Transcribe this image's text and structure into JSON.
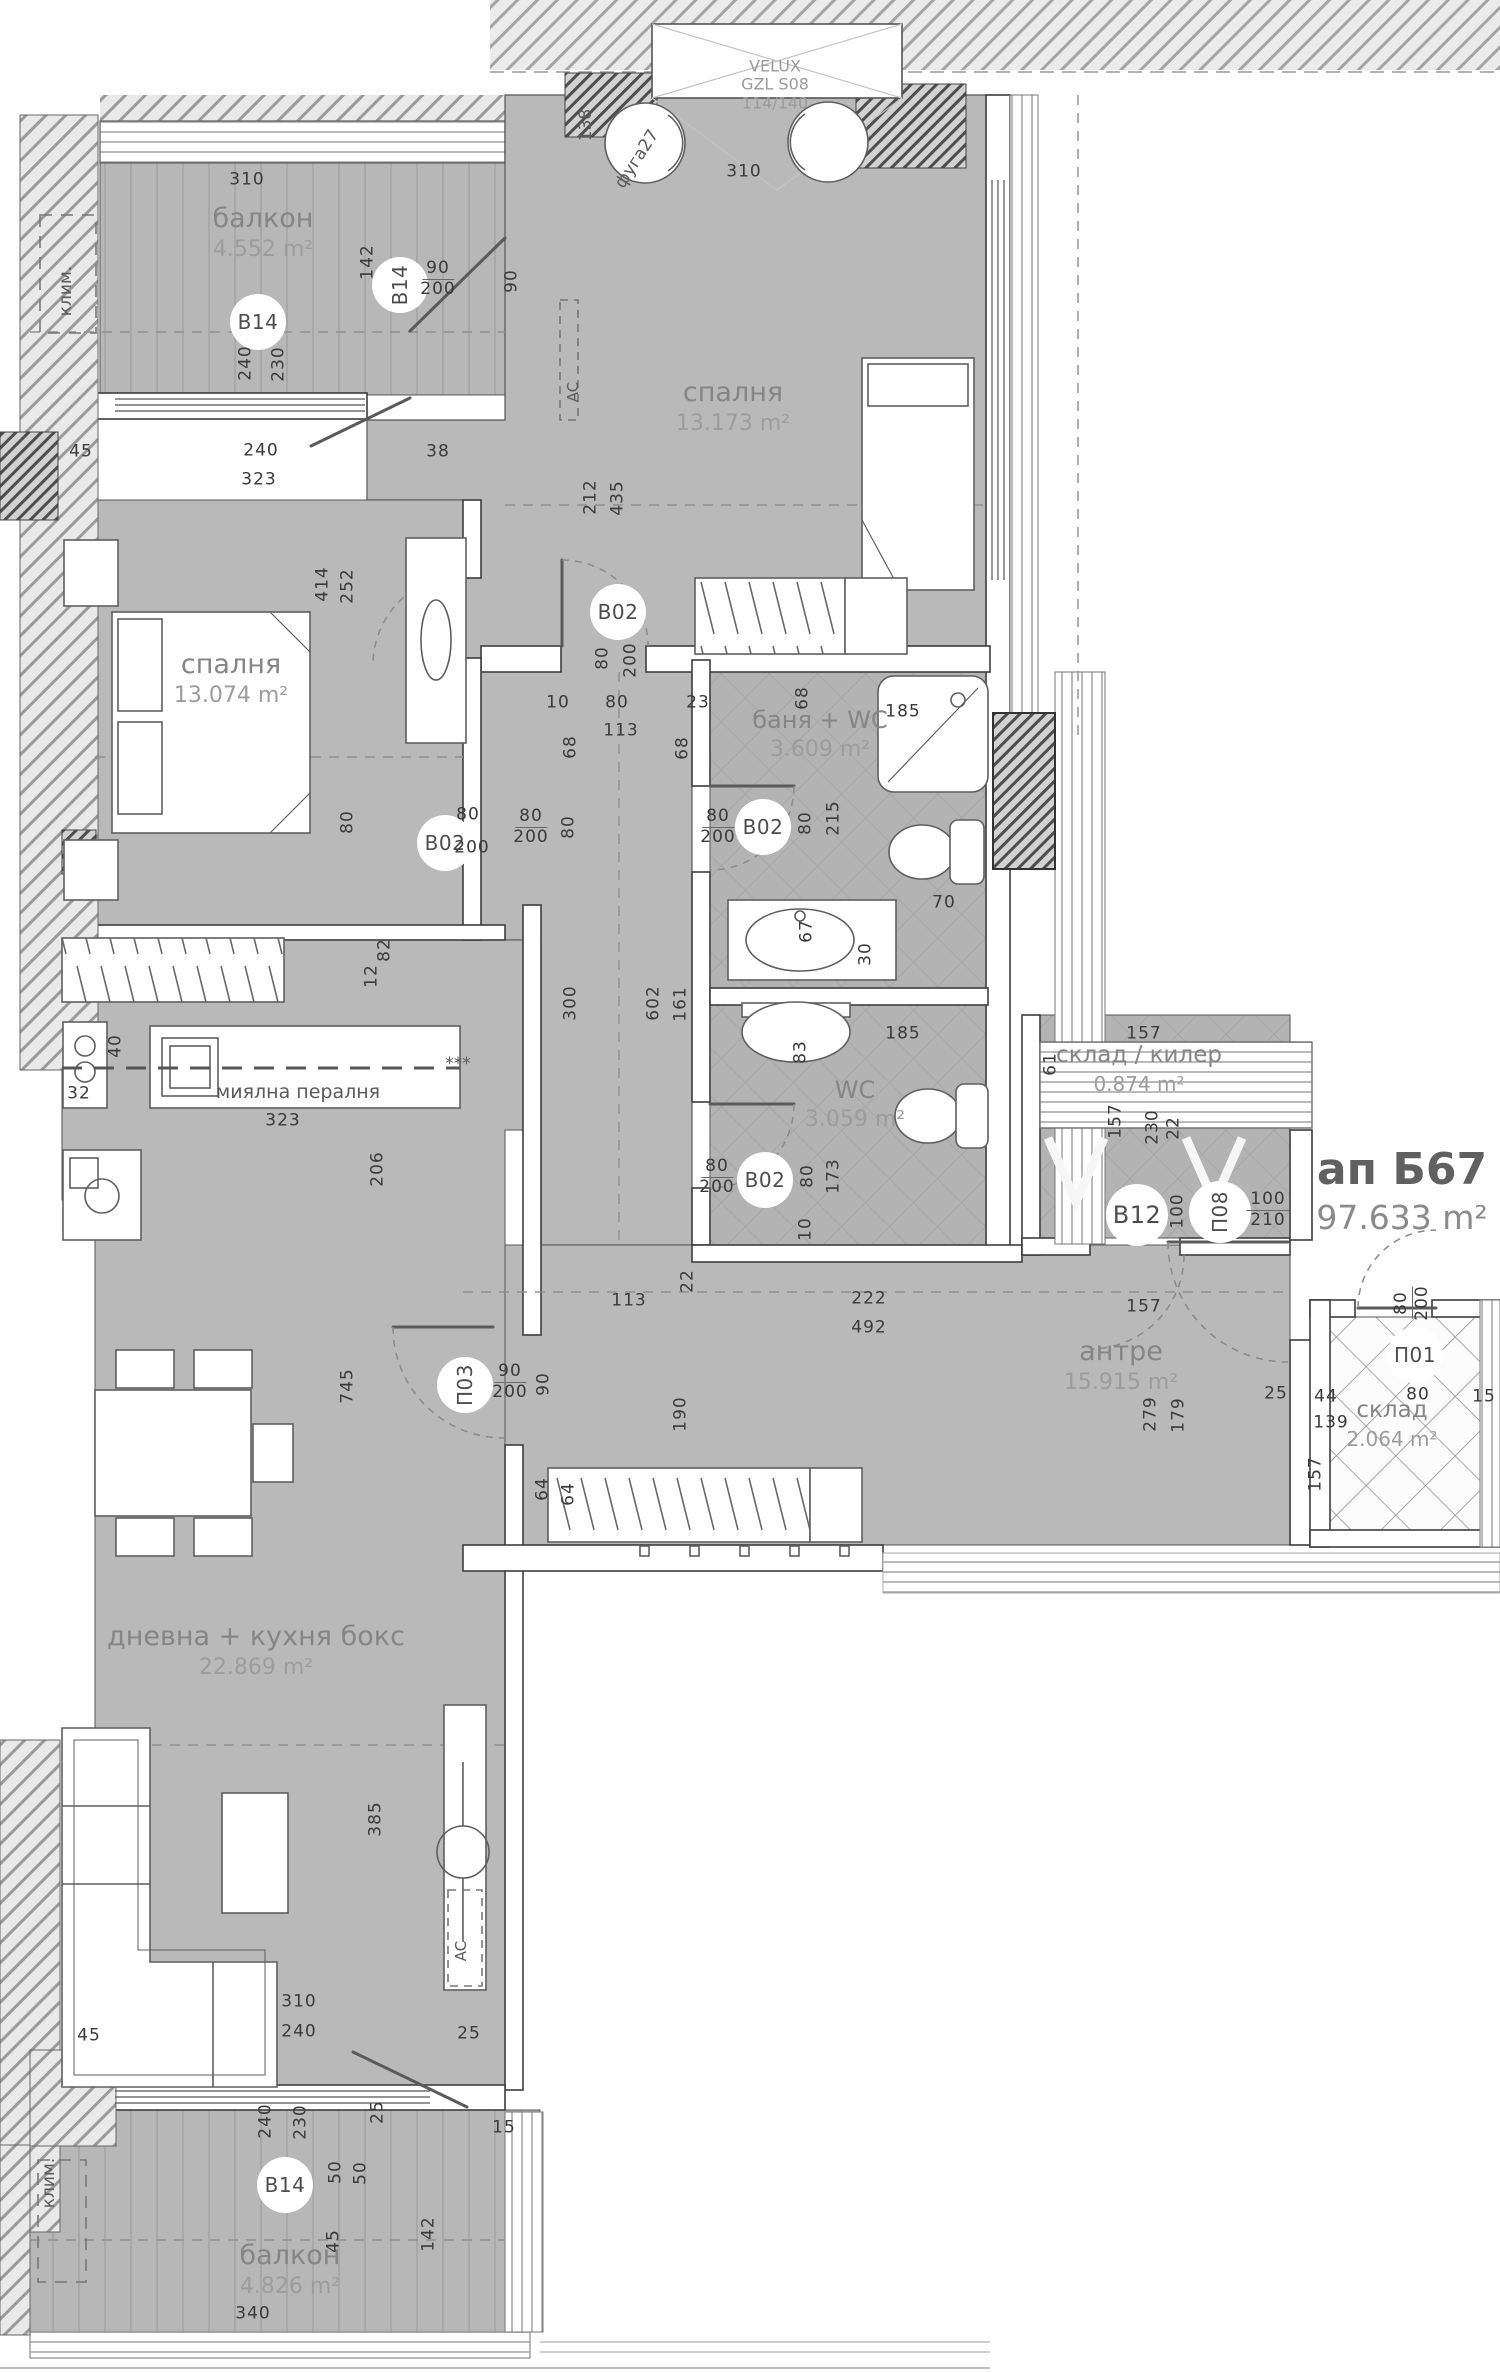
{
  "apartment": {
    "id": "ап Б67",
    "area": "97.633 m²"
  },
  "rooms": [
    {
      "key": "balcony_top",
      "name": "балкон",
      "area": "4.552 m²"
    },
    {
      "key": "bedroom_top",
      "name": "спалня",
      "area": "13.173 m²"
    },
    {
      "key": "bedroom_left",
      "name": "спалня",
      "area": "13.074 m²"
    },
    {
      "key": "bath_wc",
      "name": "баня + WC",
      "area": "3.609 m²"
    },
    {
      "key": "wc",
      "name": "WC",
      "area": "3.059 m²"
    },
    {
      "key": "storage_closet",
      "name": "склад / килер",
      "area": "0.874 m²"
    },
    {
      "key": "hallway",
      "name": "антре",
      "area": "15.915 m²"
    },
    {
      "key": "storage",
      "name": "склад",
      "area": "2.064 m²"
    },
    {
      "key": "living",
      "name": "дневна + кухня бокс",
      "area": "22.869 m²"
    },
    {
      "key": "balcony_bottom",
      "name": "балкон",
      "area": "4.826 m²"
    }
  ],
  "velux": {
    "brand": "VELUX",
    "model": "GZL S08",
    "size": "114/140"
  },
  "markers": {
    "b14": "B14",
    "b02": "B02",
    "b12": "B12",
    "p03": "П03",
    "p08": "П08",
    "p01": "П01"
  },
  "annotations": {
    "klim": "клим.",
    "ac": "AC",
    "appliances": "миялна пералня",
    "stars": "***",
    "fuga": "фуга27",
    "num138": "138"
  },
  "colors": {
    "floor": "#b9b9b9",
    "wall_line": "#3e3e3e",
    "dim_text": "#3a3a3a",
    "room_text": "#858585"
  },
  "dims": [
    "310",
    "310",
    "142",
    "90",
    "200",
    "90",
    "240",
    "230",
    "45",
    "240",
    "323",
    "38",
    "212",
    "435",
    "414",
    "252",
    "80",
    "80",
    "200",
    "10",
    "80",
    "113",
    "23",
    "68",
    "68",
    "68",
    "80",
    "200",
    "80",
    "80",
    "200",
    "80",
    "215",
    "185",
    "70",
    "67",
    "30",
    "12",
    "82",
    "40",
    "32",
    "323",
    "206",
    "300",
    "602",
    "161",
    "83",
    "185",
    "80",
    "200",
    "80",
    "173",
    "10",
    "22",
    "113",
    "222",
    "492",
    "157",
    "61",
    "157",
    "230",
    "22",
    "100",
    "100",
    "210",
    "157",
    "279",
    "179",
    "25",
    "44",
    "139",
    "80",
    "15",
    "80",
    "200",
    "157",
    "190",
    "64",
    "64",
    "745",
    "90",
    "200",
    "90",
    "385",
    "310",
    "240",
    "45",
    "25",
    "25",
    "15",
    "240",
    "230",
    "50",
    "50",
    "45",
    "142",
    "340",
    "80",
    "200"
  ]
}
